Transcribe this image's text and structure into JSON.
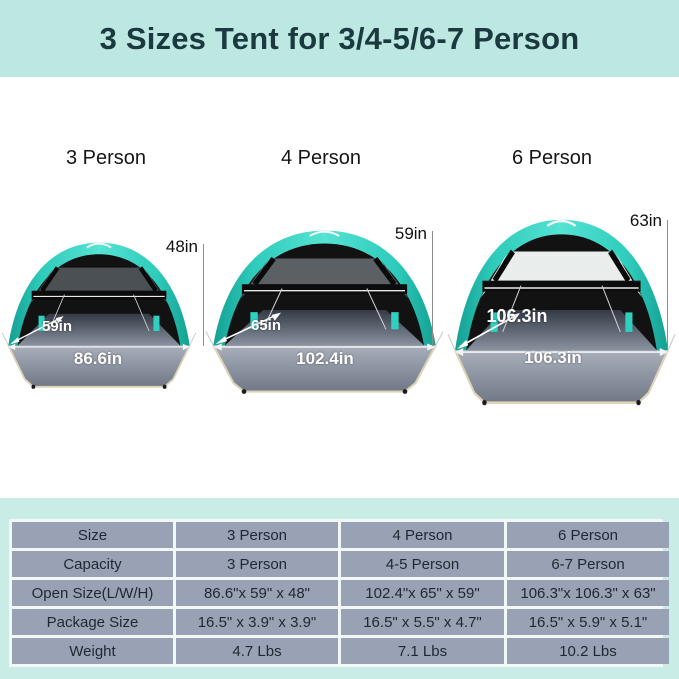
{
  "banner": {
    "title": "3 Sizes Tent for 3/4-5/6-7 Person"
  },
  "tents": [
    {
      "label": "3 Person",
      "height": "48in",
      "depth": "59in",
      "width": "86.6in"
    },
    {
      "label": "4 Person",
      "height": "59in",
      "depth": "65in",
      "width": "102.4in"
    },
    {
      "label": "6 Person",
      "height": "63in",
      "depth": "106.3in",
      "width": "106.3in"
    }
  ],
  "table": {
    "rows": [
      {
        "label": "Size",
        "values": [
          "3 Person",
          "4 Person",
          "6 Person"
        ]
      },
      {
        "label": "Capacity",
        "values": [
          "3 Person",
          "4-5 Person",
          "6-7 Person"
        ]
      },
      {
        "label": "Open Size(L/W/H)",
        "values": [
          "86.6\"x 59\" x 48\"",
          "102.4\"x 65\" x 59\"",
          "106.3\"x 106.3\" x 63\""
        ]
      },
      {
        "label": "Package Size",
        "values": [
          "16.5\" x 3.9\" x 3.9\"",
          "16.5\" x 5.5\" x 4.7\"",
          "16.5\" x 5.9\" x 5.1\""
        ]
      },
      {
        "label": "Weight",
        "values": [
          "4.7 Lbs",
          "7.1 Lbs",
          "10.2 Lbs"
        ]
      }
    ]
  },
  "colors": {
    "banner_bg": "#bce8e1",
    "banner_text": "#1b3a40",
    "mint_bg": "#c9ece6",
    "cell_bg": "#98a2b4",
    "tent_teal": "#3fd9c6",
    "floor_gray": "#8b93a1",
    "floor_border_tan": "#dcd3b6"
  }
}
